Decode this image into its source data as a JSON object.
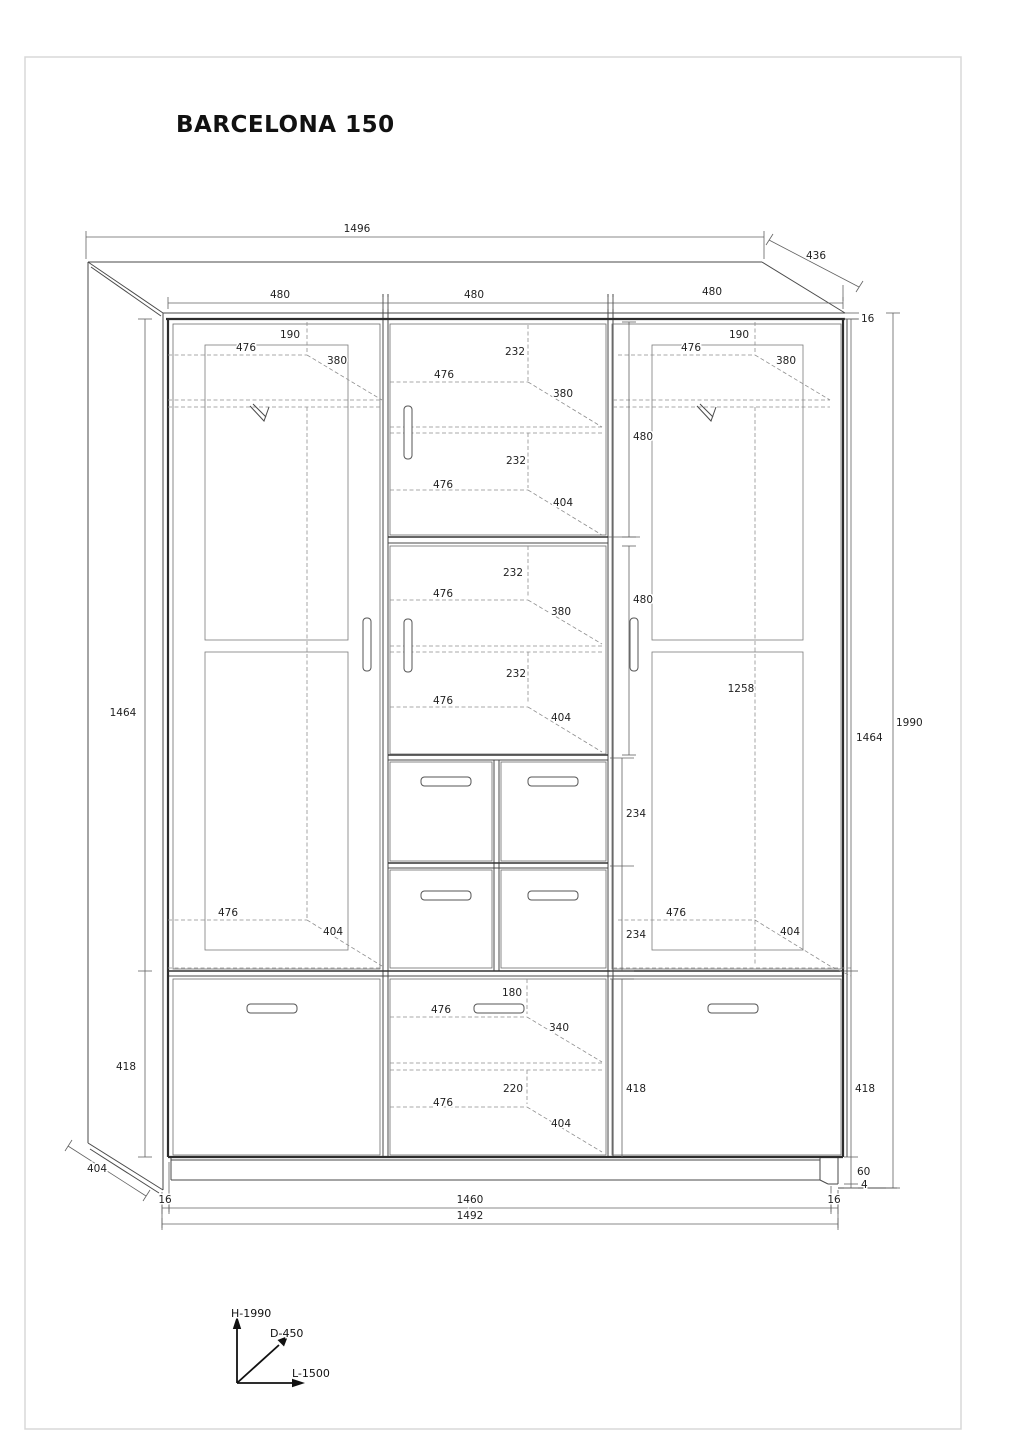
{
  "title": "BARCELONA 150",
  "dims": {
    "top": {
      "overall_width": "1496",
      "top_depth": "436",
      "left_door_width": "480",
      "middle_door_width": "480",
      "right_door_width": "480",
      "top_panel_thickness": "16"
    },
    "left_door": {
      "top_offset": "190",
      "shelf_width": "476",
      "shelf_depth": "380",
      "bottom_width": "476",
      "bottom_depth": "404"
    },
    "right_door": {
      "top_offset": "190",
      "shelf_width": "476",
      "shelf_depth": "380",
      "upper_section": "480",
      "lower_section": "480",
      "interior_height": "1258",
      "bottom_width": "476",
      "bottom_depth": "404"
    },
    "middle": {
      "s1_offset": "232",
      "s1_width": "476",
      "s1_depth": "380",
      "s1b_offset": "232",
      "s1b_width": "476",
      "s1b_depth": "404",
      "s2_offset": "232",
      "s2_width": "476",
      "s2_depth": "380",
      "s2b_offset": "232",
      "s2b_width": "476",
      "s2b_depth": "404",
      "drawer_upper": "234",
      "drawer_lower": "234",
      "bottom_offset": "180",
      "bottom_width": "476",
      "bottom_depth": "340",
      "bottom2_offset": "220",
      "bottom2_width": "476",
      "bottom2_depth": "404",
      "bottom_height": "418"
    },
    "left_side": {
      "door_height": "1464",
      "drawer_height": "418",
      "depth": "404"
    },
    "right_side": {
      "door_height": "1464",
      "total_height": "1990",
      "drawer_height": "418",
      "plinth_height": "60",
      "glide_height": "4"
    },
    "bottom": {
      "left_thickness": "16",
      "inner_width": "1460",
      "right_thickness": "16",
      "outer_width": "1492"
    }
  },
  "axis": {
    "height": "H-1990",
    "depth": "D-450",
    "length": "L-1500"
  }
}
